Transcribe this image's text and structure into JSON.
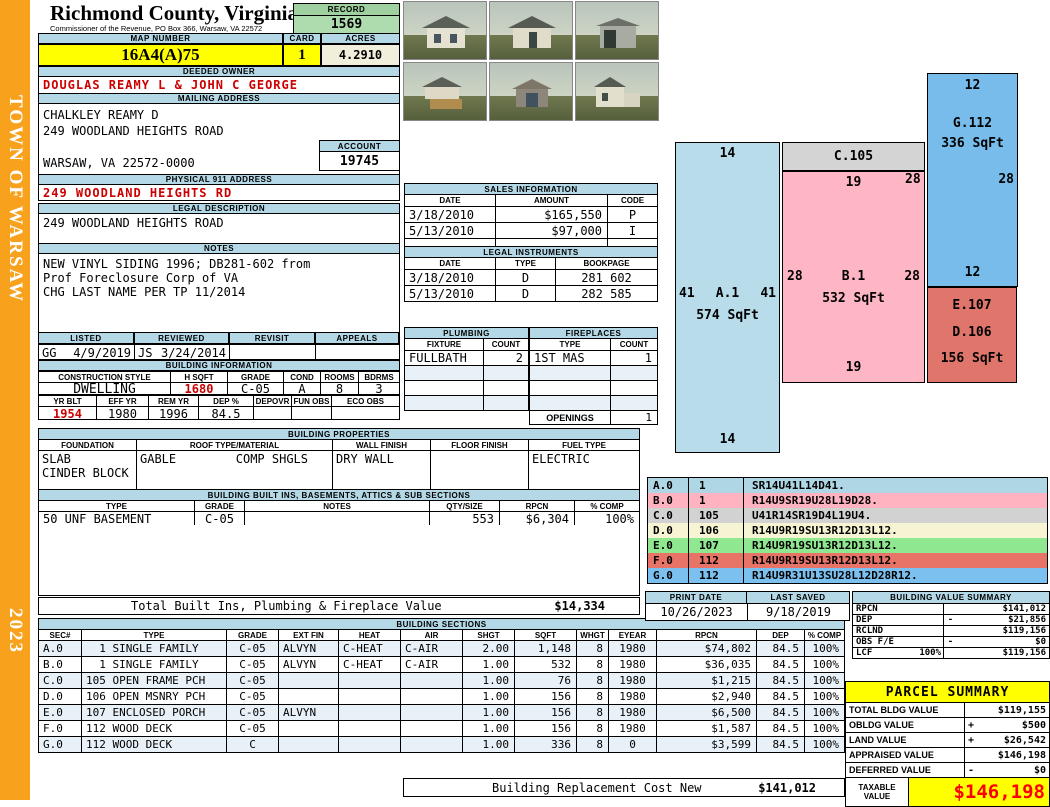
{
  "sidebar": {
    "title": "TOWN OF WARSAW",
    "year": "2023"
  },
  "header": {
    "county": "Richmond County, Virginia",
    "commissioner": "Commissioner of the Revenue, PO Box 366, Warsaw, VA 22572",
    "record_label": "RECORD",
    "record": "1569"
  },
  "parcel": {
    "map_label": "MAP NUMBER",
    "map_number": "16A4(A)75",
    "card_label": "CARD",
    "card": "1",
    "acres_label": "ACRES",
    "acres": "4.2910",
    "owner_label": "DEEDED OWNER",
    "owner": "DOUGLAS REAMY L & JOHN C GEORGE",
    "mailing_label": "MAILING ADDRESS",
    "mailing_lines": [
      "CHALKLEY REAMY D",
      "249 WOODLAND HEIGHTS ROAD",
      "",
      "WARSAW, VA 22572-0000"
    ],
    "account_label": "ACCOUNT",
    "account": "19745",
    "physical_label": "PHYSICAL 911 ADDRESS",
    "physical": "249 WOODLAND HEIGHTS RD",
    "legal_label": "LEGAL DESCRIPTION",
    "legal": "249 WOODLAND HEIGHTS ROAD",
    "notes_label": "NOTES",
    "notes_lines": [
      "NEW VINYL SIDING 1996; DB281-602 from",
      "Prof Foreclosure Corp of VA",
      "CHG LAST NAME PER TP 11/2014"
    ]
  },
  "review": {
    "headers": [
      "LISTED",
      "REVIEWED",
      "REVISIT",
      "APPEALS"
    ],
    "listed_by": "GG",
    "listed_date": "4/9/2019",
    "reviewed_by": "JS",
    "reviewed_date": "3/24/2014",
    "revisit": "",
    "appeals": ""
  },
  "building_info": {
    "title": "BUILDING INFORMATION",
    "headers1": [
      "CONSTRUCTION STYLE",
      "H SQFT",
      "GRADE",
      "COND",
      "ROOMS",
      "BDRMS"
    ],
    "row1": [
      {
        "style": "DWELLING",
        "hsqft": "1680",
        "grade": "C-05",
        "cond": "A",
        "rooms": "8",
        "bdrms": "3"
      }
    ],
    "headers2": [
      "YR BLT",
      "EFF YR",
      "REM YR",
      "DEP %",
      "DEPOVR",
      "FUN OBS",
      "ECO OBS"
    ],
    "row2": [
      {
        "yrblt": "1954",
        "effyr": "1980",
        "remyr": "1996",
        "deppct": "84.5",
        "depovr": "",
        "funobs": "",
        "ecoobs": ""
      }
    ]
  },
  "sales": {
    "title": "SALES INFORMATION",
    "headers": [
      "DATE",
      "AMOUNT",
      "CODE"
    ],
    "rows": [
      {
        "date": "3/18/2010",
        "amount": "$165,550",
        "code": "P"
      },
      {
        "date": "5/13/2010",
        "amount": "$97,000",
        "code": "I"
      },
      {
        "date": "",
        "amount": "",
        "code": ""
      }
    ]
  },
  "legal_instruments": {
    "title": "LEGAL INSTRUMENTS",
    "headers": [
      "DATE",
      "TYPE",
      "BOOKPAGE"
    ],
    "rows": [
      {
        "date": "3/18/2010",
        "type2": "D",
        "book": "281 602"
      },
      {
        "date": "5/13/2010",
        "type2": "D",
        "book": "282 585"
      }
    ]
  },
  "plumbing": {
    "title": "PLUMBING",
    "headers": [
      "FIXTURE",
      "COUNT"
    ],
    "rows": [
      {
        "fixture": "FULLBATH",
        "count": "2"
      },
      {
        "fixture": "",
        "count": ""
      },
      {
        "fixture": "",
        "count": ""
      },
      {
        "fixture": "",
        "count": ""
      }
    ]
  },
  "fireplaces": {
    "title": "FIREPLACES",
    "headers": [
      "TYPE",
      "COUNT"
    ],
    "rows": [
      {
        "ftype": "1ST MAS",
        "count": "1"
      },
      {
        "ftype": "",
        "count": ""
      },
      {
        "ftype": "",
        "count": ""
      },
      {
        "ftype": "",
        "count": ""
      }
    ],
    "openings_label": "OPENINGS",
    "openings_count": "1"
  },
  "building_properties": {
    "title": "BUILDING PROPERTIES",
    "headers": [
      "FOUNDATION",
      "ROOF TYPE/MATERIAL",
      "WALL FINISH",
      "FLOOR FINISH",
      "FUEL TYPE"
    ],
    "foundation": "SLAB\nCINDER BLOCK",
    "roof_type": "GABLE",
    "roof_material": "COMP SHGLS",
    "wall_finish": "DRY WALL",
    "floor_finish": "",
    "fuel_type": "ELECTRIC"
  },
  "builtins": {
    "title": "BUILDING BUILT INS, BASEMENTS, ATTICS & SUB SECTIONS",
    "headers": [
      "TYPE",
      "GRADE",
      "NOTES",
      "QTY/SIZE",
      "RPCN",
      "% COMP"
    ],
    "rows": [
      {
        "btype": "50 UNF BASEMENT",
        "grade": "C-05",
        "notes": "",
        "qty": "553",
        "rpcn": "$6,304",
        "comp": "100%"
      }
    ]
  },
  "totals": {
    "builtins_label": "Total Built Ins, Plumbing & Fireplace Value",
    "builtins_value": "$14,334",
    "rcn_label": "Building Replacement Cost New",
    "rcn_value": "$141,012"
  },
  "sections": {
    "title": "BUILDING SECTIONS",
    "headers": [
      "SEC#",
      "TYPE",
      "GRADE",
      "EXT FIN",
      "HEAT",
      "AIR",
      "SHGT",
      "SQFT",
      "WHGT",
      "EYEAR",
      "RPCN",
      "DEP",
      "% COMP"
    ],
    "rows": [
      {
        "sec": "A.0",
        "type": "  1 SINGLE FAMILY",
        "grade": "C-05",
        "extfin": "ALVYN",
        "heat": "C-HEAT",
        "air": "C-AIR",
        "shgt": "2.00",
        "sqft": "1,148",
        "whgt": "8",
        "eyear": "1980",
        "rpcn": "$74,802",
        "dep": "84.5",
        "comp": "100%"
      },
      {
        "sec": "B.0",
        "type": "  1 SINGLE FAMILY",
        "grade": "C-05",
        "extfin": "ALVYN",
        "heat": "C-HEAT",
        "air": "C-AIR",
        "shgt": "1.00",
        "sqft": "532",
        "whgt": "8",
        "eyear": "1980",
        "rpcn": "$36,035",
        "dep": "84.5",
        "comp": "100%"
      },
      {
        "sec": "C.0",
        "type": "105 OPEN FRAME PCH",
        "grade": "C-05",
        "extfin": "",
        "heat": "",
        "air": "",
        "shgt": "1.00",
        "sqft": "76",
        "whgt": "8",
        "eyear": "1980",
        "rpcn": "$1,215",
        "dep": "84.5",
        "comp": "100%"
      },
      {
        "sec": "D.0",
        "type": "106 OPEN MSNRY PCH",
        "grade": "C-05",
        "extfin": "",
        "heat": "",
        "air": "",
        "shgt": "1.00",
        "sqft": "156",
        "whgt": "8",
        "eyear": "1980",
        "rpcn": "$2,940",
        "dep": "84.5",
        "comp": "100%"
      },
      {
        "sec": "E.0",
        "type": "107 ENCLOSED PORCH",
        "grade": "C-05",
        "extfin": "ALVYN",
        "heat": "",
        "air": "",
        "shgt": "1.00",
        "sqft": "156",
        "whgt": "8",
        "eyear": "1980",
        "rpcn": "$6,500",
        "dep": "84.5",
        "comp": "100%"
      },
      {
        "sec": "F.0",
        "type": "112 WOOD DECK",
        "grade": "C-05",
        "extfin": "",
        "heat": "",
        "air": "",
        "shgt": "1.00",
        "sqft": "156",
        "whgt": "8",
        "eyear": "1980",
        "rpcn": "$1,587",
        "dep": "84.5",
        "comp": "100%"
      },
      {
        "sec": "G.0",
        "type": "112 WOOD DECK",
        "grade": "C",
        "extfin": "",
        "heat": "",
        "air": "",
        "shgt": "1.00",
        "sqft": "336",
        "whgt": "8",
        "eyear": "0",
        "rpcn": "$3,599",
        "dep": "84.5",
        "comp": "100%"
      }
    ]
  },
  "sketch": {
    "a": {
      "top": "14",
      "left": "41",
      "name": "A.1",
      "right": "41",
      "area": "574 SqFt",
      "bottom": "14"
    },
    "c": {
      "name": "C.105"
    },
    "b": {
      "top": "19",
      "left": "28",
      "name": "B.1",
      "right": "28",
      "area": "532 SqFt",
      "bottom": "19"
    },
    "g": {
      "top": "12",
      "name": "G.112",
      "area": "336 SqFt",
      "left": "28",
      "right": "28",
      "bottom": "12"
    },
    "ed": {
      "name1": "E.107",
      "name2": "D.106",
      "area": "156 SqFt"
    }
  },
  "legend": {
    "rows": [
      {
        "lcode": "A.0",
        "lnum": "1",
        "vector": "SR14U41L14D41.",
        "_bg": "#aed6e4"
      },
      {
        "lcode": "B.0",
        "lnum": "1",
        "vector": "R14U9SR19U28L19D28.",
        "_bg": "#ffb3c0"
      },
      {
        "lcode": "C.0",
        "lnum": "105",
        "vector": "U41R14SR19D4L19U4.",
        "_bg": "#d2d2d2"
      },
      {
        "lcode": "D.0",
        "lnum": "106",
        "vector": "R14U9R19SU13R12D13L12.",
        "_bg": "#f6f4d2"
      },
      {
        "lcode": "E.0",
        "lnum": "107",
        "vector": "R14U9R19SU13R12D13L12.",
        "_bg": "#8fe88f"
      },
      {
        "lcode": "F.0",
        "lnum": "112",
        "vector": "R14U9R19SU13R12D13L12.",
        "_bg": "#e87468"
      },
      {
        "lcode": "G.0",
        "lnum": "112",
        "vector": "R14U9R31U13SU28L12D28R12.",
        "_bg": "#7cc0f0"
      }
    ]
  },
  "print_info": {
    "print_date_label": "PRINT DATE",
    "print_date": "10/26/2023",
    "last_saved_label": "LAST SAVED",
    "last_saved": "9/18/2019"
  },
  "value_summary": {
    "title": "BUILDING VALUE SUMMARY",
    "rows": [
      {
        "label": "RPCN",
        "pct": "",
        "sign": "",
        "amount": "$141,012"
      },
      {
        "label": "DEP",
        "pct": "",
        "sign": "-",
        "amount": "$21,856"
      },
      {
        "label": "RCLND",
        "pct": "",
        "sign": "",
        "amount": "$119,156"
      },
      {
        "label": "OBS F/E",
        "pct": "",
        "sign": "-",
        "amount": "$0"
      },
      {
        "label": "LCF",
        "pct": "100%",
        "sign": "",
        "amount": "$119,156"
      }
    ]
  },
  "parcel_summary": {
    "title": "PARCEL SUMMARY",
    "rows": [
      {
        "label": "TOTAL BLDG VALUE",
        "sign": "",
        "amount": "$119,155"
      },
      {
        "label": "OBLDG VALUE",
        "sign": "+",
        "amount": "$500"
      },
      {
        "label": "LAND VALUE",
        "sign": "+",
        "amount": "$26,542"
      },
      {
        "label": "APPRAISED VALUE",
        "sign": "",
        "amount": "$146,198"
      },
      {
        "label": "DEFERRED VALUE",
        "sign": "-",
        "amount": "$0"
      }
    ],
    "taxable_label": "TAXABLE VALUE",
    "taxable": "$146,198"
  },
  "colors": {
    "sidebar_orange": "#f7a11c",
    "bar_blue": "#b5d8e6",
    "highlight_yellow": "#ffff00",
    "record_green_header": "#9fd09f",
    "record_green_value": "#aedcae",
    "acres_cream": "#f1eedb",
    "alert_red": "#cc0000",
    "taxable_red": "#ff0000",
    "sketch_a": "#b8dcea",
    "sketch_b": "#ffb6c4",
    "sketch_c": "#d4d4d4",
    "sketch_g": "#77bceb",
    "sketch_ed": "#e0756b"
  }
}
